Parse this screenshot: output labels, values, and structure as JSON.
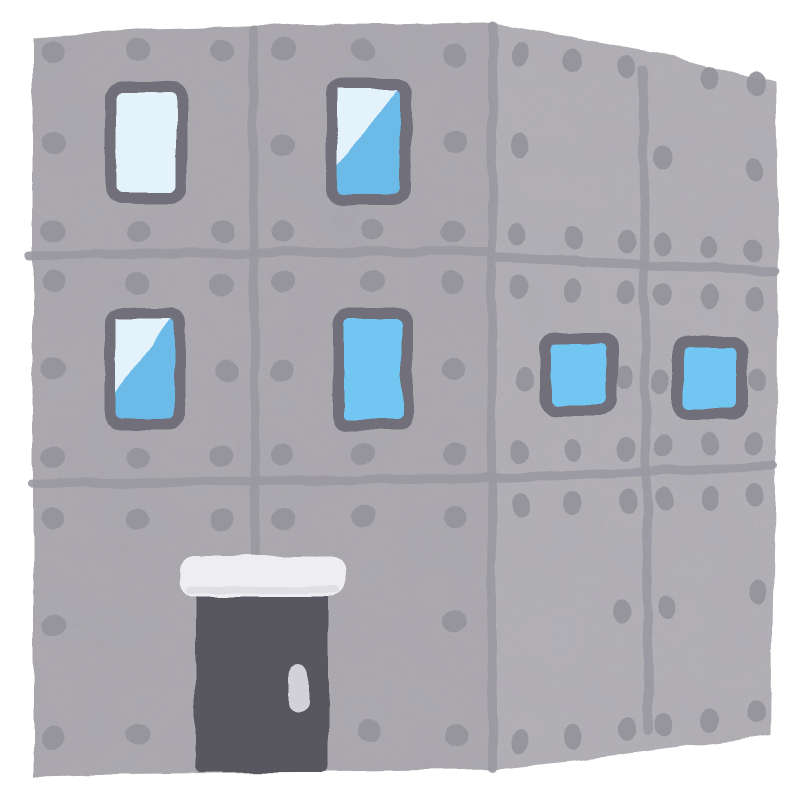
{
  "illustration": {
    "subject": "concrete-building",
    "background": "#ffffff",
    "palette": {
      "wall_front": "#b1afb4",
      "wall_side": "#b8b6bb",
      "dot": "#95939b",
      "seam": "#9a98a0",
      "window_frame": "#716f7a",
      "glass_pale": "#e4f3fb",
      "glass_blue": "#72c6f2",
      "glass_blue_deep": "#6cbae7",
      "door": "#59575e",
      "door_handle": "#d2d1d7",
      "lintel": "#eeedf1",
      "lintel_shade": "#dcdbe1",
      "texture_dark": "#6c6a74",
      "texture_mottle": "#8a8892"
    },
    "faces": {
      "front": {
        "path": "M33 38 L150 29 L300 25 L492 24 L492 769 L300 772 L120 774 L33 776 Z"
      },
      "side": {
        "path": "M492 24 L570 37 L660 53 L776 83 L778 200 L777 420 L773 600 L771 736 L690 746 L580 760 L492 769 Z"
      }
    },
    "seams": [
      {
        "name": "front-horizontal-seam-1",
        "d": "M30 255 L492 251",
        "w": 9
      },
      {
        "name": "front-horizontal-seam-2",
        "d": "M32 484 L492 478",
        "w": 9
      },
      {
        "name": "front-vertical-seam",
        "d": "M253 30 L255 556",
        "w": 9
      },
      {
        "name": "corner-seam",
        "d": "M492 27 L492 767",
        "w": 9
      },
      {
        "name": "side-horizontal-seam-1",
        "d": "M492 257 L775 271",
        "w": 9
      },
      {
        "name": "side-horizontal-seam-2",
        "d": "M492 479 L773 466",
        "w": 9
      },
      {
        "name": "side-vertical-seam",
        "d": "M643 69 L648 731",
        "w": 9
      }
    ],
    "dots": {
      "front": [
        [
          53,
          52
        ],
        [
          138,
          50
        ],
        [
          222,
          50
        ],
        [
          283,
          50
        ],
        [
          363,
          50
        ],
        [
          455,
          56
        ],
        [
          53,
          143
        ],
        [
          283,
          144
        ],
        [
          455,
          142
        ],
        [
          53,
          230
        ],
        [
          138,
          232
        ],
        [
          222,
          231
        ],
        [
          283,
          232
        ],
        [
          372,
          230
        ],
        [
          453,
          232
        ],
        [
          53,
          282
        ],
        [
          138,
          283
        ],
        [
          222,
          284
        ],
        [
          283,
          283
        ],
        [
          372,
          281
        ],
        [
          453,
          283
        ],
        [
          53,
          368
        ],
        [
          227,
          372
        ],
        [
          283,
          372
        ],
        [
          453,
          370
        ],
        [
          53,
          457
        ],
        [
          138,
          458
        ],
        [
          222,
          455
        ],
        [
          283,
          454
        ],
        [
          363,
          453
        ],
        [
          455,
          455
        ],
        [
          53,
          518
        ],
        [
          138,
          519
        ],
        [
          222,
          520
        ],
        [
          283,
          519
        ],
        [
          363,
          516
        ],
        [
          455,
          518
        ],
        [
          53,
          625
        ],
        [
          455,
          620
        ],
        [
          53,
          738
        ],
        [
          138,
          735
        ],
        [
          369,
          731
        ],
        [
          457,
          737
        ]
      ],
      "side": [
        [
          520,
          54
        ],
        [
          573,
          61
        ],
        [
          627,
          67
        ],
        [
          710,
          77
        ],
        [
          757,
          84
        ],
        [
          520,
          146
        ],
        [
          663,
          158
        ],
        [
          755,
          169
        ],
        [
          518,
          234
        ],
        [
          573,
          238
        ],
        [
          627,
          241
        ],
        [
          663,
          244
        ],
        [
          710,
          247
        ],
        [
          753,
          250
        ],
        [
          518,
          286
        ],
        [
          573,
          290
        ],
        [
          627,
          293
        ],
        [
          663,
          295
        ],
        [
          710,
          297
        ],
        [
          755,
          299
        ],
        [
          525,
          379
        ],
        [
          625,
          378
        ],
        [
          661,
          381
        ],
        [
          757,
          380
        ],
        [
          520,
          452
        ],
        [
          573,
          450
        ],
        [
          627,
          448
        ],
        [
          663,
          446
        ],
        [
          710,
          444
        ],
        [
          755,
          443
        ],
        [
          520,
          506
        ],
        [
          573,
          504
        ],
        [
          627,
          502
        ],
        [
          663,
          500
        ],
        [
          710,
          498
        ],
        [
          755,
          495
        ],
        [
          622,
          611
        ],
        [
          667,
          606
        ],
        [
          757,
          593
        ],
        [
          520,
          741
        ],
        [
          573,
          737
        ],
        [
          627,
          729
        ],
        [
          663,
          725
        ],
        [
          710,
          720
        ],
        [
          757,
          712
        ]
      ],
      "front_rx": 12,
      "front_ry": 11,
      "side_rx": 9,
      "side_ry": 12
    },
    "windows": [
      {
        "id": "window-1",
        "x": 105,
        "y": 82,
        "w": 82,
        "h": 122,
        "glass": "pale"
      },
      {
        "id": "window-2",
        "x": 326,
        "y": 78,
        "w": 86,
        "h": 127,
        "glass": "diagonal"
      },
      {
        "id": "window-3",
        "x": 105,
        "y": 308,
        "w": 80,
        "h": 122,
        "glass": "diagonal"
      },
      {
        "id": "window-4",
        "x": 332,
        "y": 308,
        "w": 81,
        "h": 122,
        "glass": "solid"
      },
      {
        "id": "window-5",
        "x": 540,
        "y": 332,
        "w": 78,
        "h": 84,
        "glass": "solid"
      },
      {
        "id": "window-6",
        "x": 673,
        "y": 336,
        "w": 74,
        "h": 84,
        "glass": "solid"
      }
    ],
    "window_style": {
      "frame_thickness": 11,
      "outer_radius": 16,
      "glass_radius": 6
    },
    "door": {
      "x": 196,
      "y": 592,
      "w": 132,
      "h": 180,
      "radius": 6,
      "lintel": {
        "x": 180,
        "y": 556,
        "w": 166,
        "h": 40,
        "radius": 15
      },
      "handle": {
        "x": 288,
        "y": 664,
        "w": 20,
        "h": 48,
        "radius": 10
      }
    }
  }
}
